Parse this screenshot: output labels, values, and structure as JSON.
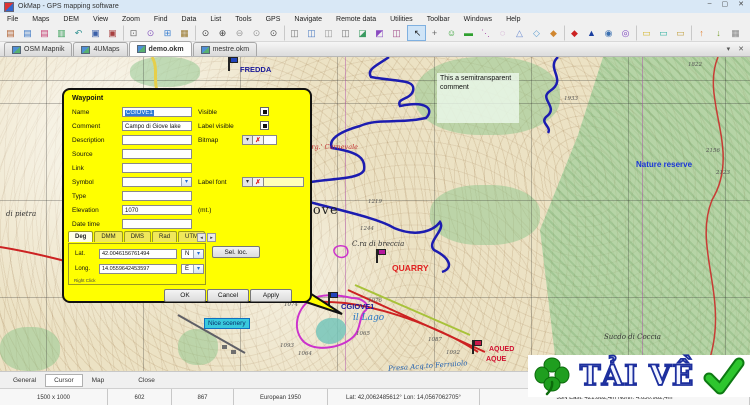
{
  "window": {
    "title": "OkMap - GPS mapping software",
    "controls": {
      "minimize": "–",
      "maximize": "▢",
      "close": "✕"
    }
  },
  "menu": {
    "items": [
      "File",
      "Maps",
      "DEM",
      "View",
      "Zoom",
      "Find",
      "Data",
      "List",
      "Tools",
      "GPS",
      "Navigate",
      "Remote data",
      "Utilities",
      "Toolbar",
      "Windows",
      "Help"
    ]
  },
  "toolbar": {
    "icons": [
      {
        "name": "open-map-icon",
        "glyph": "▤",
        "color": "#b06030"
      },
      {
        "name": "add-map-icon",
        "glyph": "▤",
        "color": "#3a76c4"
      },
      {
        "name": "remove-map-icon",
        "glyph": "▤",
        "color": "#c43a6e"
      },
      {
        "name": "map-list-icon",
        "glyph": "▥",
        "color": "#3aa05a"
      },
      {
        "name": "reload-map-icon",
        "glyph": "↶",
        "color": "#2e9090"
      },
      {
        "name": "save-icon",
        "glyph": "▣",
        "color": "#3a5fa8"
      },
      {
        "name": "save-as-icon",
        "glyph": "▣",
        "color": "#a84040"
      },
      {
        "name": "zoom-window-icon",
        "glyph": "⊡",
        "color": "#666666",
        "sep": true
      },
      {
        "name": "zoom-pan-icon",
        "glyph": "⊙",
        "color": "#8a5fc0"
      },
      {
        "name": "open-workspace-icon",
        "glyph": "⊞",
        "color": "#3a7fd0"
      },
      {
        "name": "briefcase-icon",
        "glyph": "▦",
        "color": "#9a7a30"
      },
      {
        "name": "find-icon",
        "glyph": "⊙",
        "color": "#444444",
        "sep": true
      },
      {
        "name": "zoom-in-icon",
        "glyph": "⊕",
        "color": "#444444"
      },
      {
        "name": "zoom-out-icon",
        "glyph": "⊖",
        "color": "#999999"
      },
      {
        "name": "zoom-previous-icon",
        "glyph": "⊙",
        "color": "#999999"
      },
      {
        "name": "zoom-scale-icon",
        "glyph": "⊙",
        "color": "#555555"
      },
      {
        "name": "waypoint-list-icon",
        "glyph": "◫",
        "color": "#777777",
        "sep": true
      },
      {
        "name": "route-list-icon",
        "glyph": "◫",
        "color": "#4a7ac0"
      },
      {
        "name": "track-list-icon",
        "glyph": "◫",
        "color": "#999999"
      },
      {
        "name": "area-list-icon",
        "glyph": "◫",
        "color": "#777777"
      },
      {
        "name": "upload-data-icon",
        "glyph": "◪",
        "color": "#3a9a60"
      },
      {
        "name": "download-data-icon",
        "glyph": "◩",
        "color": "#8a4ac0"
      },
      {
        "name": "sync-data-icon",
        "glyph": "◫",
        "color": "#a04a88"
      },
      {
        "name": "select-pointer-icon",
        "glyph": "↖",
        "color": "#222222",
        "active": true,
        "sep": true
      },
      {
        "name": "pan-tool-icon",
        "glyph": "+",
        "color": "#666666"
      },
      {
        "name": "new-waypoint-icon",
        "glyph": "☺",
        "color": "#2fa02f"
      },
      {
        "name": "new-label-icon",
        "glyph": "▬",
        "color": "#2fa02f"
      },
      {
        "name": "new-route-icon",
        "glyph": "⋱",
        "color": "#b05fb0"
      },
      {
        "name": "new-track-icon",
        "glyph": "◌",
        "color": "#b05fb0"
      },
      {
        "name": "new-area-icon",
        "glyph": "△",
        "color": "#6a8ad0"
      },
      {
        "name": "new-polygon-icon",
        "glyph": "◇",
        "color": "#5f9fd0"
      },
      {
        "name": "new-shape-icon",
        "glyph": "◆",
        "color": "#d0862f"
      },
      {
        "name": "center-map-icon",
        "glyph": "◆",
        "color": "#cc2222",
        "sep": true
      },
      {
        "name": "goto-position-icon",
        "glyph": "▲",
        "color": "#1a3fa0"
      },
      {
        "name": "rotate-map-icon",
        "glyph": "◉",
        "color": "#3a6fb0"
      },
      {
        "name": "projection-icon",
        "glyph": "◎",
        "color": "#7a3fbf"
      },
      {
        "name": "measure-distance-icon",
        "glyph": "▭",
        "color": "#d4b62e",
        "sep": true
      },
      {
        "name": "measure-area-icon",
        "glyph": "▭",
        "color": "#2fb0a0"
      },
      {
        "name": "measure-bearing-icon",
        "glyph": "▭",
        "color": "#c09f3f"
      },
      {
        "name": "gps-upload-icon",
        "glyph": "↑",
        "color": "#e07f2f",
        "sep": true
      },
      {
        "name": "gps-download-icon",
        "glyph": "↓",
        "color": "#79a02f"
      },
      {
        "name": "data-grid-icon",
        "glyph": "▦",
        "color": "#8a8a8a"
      }
    ]
  },
  "tabbar": {
    "tabs": [
      {
        "label": "OSM Mapnik"
      },
      {
        "label": "4UMaps"
      },
      {
        "label": "demo.okm",
        "active": true
      },
      {
        "label": "mestre.okm"
      }
    ],
    "dropdown_glyph": "▾",
    "close_glyph": "✕"
  },
  "map": {
    "comment_note": "This a semitransparent comment",
    "chip": {
      "text": "Nice scenery",
      "x": 204,
      "y": 261
    },
    "colors": {
      "track": "#1c1cb0",
      "route": "#cc2222",
      "area": "#cc33cc",
      "road_yellow": "#e6cf4a",
      "road_green": "#a8c23a",
      "road_gray": "#5f5f66"
    },
    "labels": [
      {
        "text": "FREDDA",
        "x": 240,
        "y": 8,
        "cls": "lbl-navy-bold"
      },
      {
        "text": "Sorg.' Carnevale",
        "x": 303,
        "y": 86,
        "cls": "lbl-red-italic"
      },
      {
        "text": "Nature reserve",
        "x": 636,
        "y": 103,
        "cls": "lbl-blue-bold"
      },
      {
        "text": "i Giove",
        "x": 286,
        "y": 146,
        "cls": "lbl-serif-big"
      },
      {
        "text": "C.ra di breccia",
        "x": 352,
        "y": 183,
        "cls": "lbl-italic"
      },
      {
        "text": "QUARRY",
        "x": 392,
        "y": 206,
        "cls": "lbl-red-bold"
      },
      {
        "text": "CGIOVE1",
        "x": 341,
        "y": 245,
        "cls": "lbl-navy-bold"
      },
      {
        "text": "il Lago",
        "x": 353,
        "y": 256,
        "cls": "lbl-blue-italic-lg"
      },
      {
        "text": "Sucdo di Coccia",
        "x": 604,
        "y": 276,
        "cls": "lbl-italic"
      },
      {
        "text": "Presa Acq.to Ferraiolo",
        "x": 388,
        "y": 305,
        "cls": "lbl-blue-italic",
        "transform": "rotate(-4deg)"
      },
      {
        "text": "AQUED",
        "x": 489,
        "y": 289,
        "cls": "lbl-red-bold-sm"
      },
      {
        "text": "AQUE",
        "x": 486,
        "y": 299,
        "cls": "lbl-red-bold-sm"
      },
      {
        "text": "di pietra",
        "x": 6,
        "y": 153,
        "cls": "lbl-italic"
      },
      {
        "text": "1074",
        "x": 284,
        "y": 245,
        "cls": "lbl-elev"
      },
      {
        "text": "1076",
        "x": 368,
        "y": 241,
        "cls": "lbl-elev"
      },
      {
        "text": "1065",
        "x": 356,
        "y": 274,
        "cls": "lbl-elev"
      },
      {
        "text": "1064",
        "x": 298,
        "y": 294,
        "cls": "lbl-elev"
      },
      {
        "text": "1093",
        "x": 280,
        "y": 286,
        "cls": "lbl-elev"
      },
      {
        "text": "1087",
        "x": 428,
        "y": 280,
        "cls": "lbl-elev"
      },
      {
        "text": "1092",
        "x": 446,
        "y": 293,
        "cls": "lbl-elev"
      },
      {
        "text": "1219",
        "x": 368,
        "y": 142,
        "cls": "lbl-elev"
      },
      {
        "text": "1244",
        "x": 360,
        "y": 169,
        "cls": "lbl-elev"
      },
      {
        "text": "1933",
        "x": 564,
        "y": 39,
        "cls": "lbl-elev"
      },
      {
        "text": "2156",
        "x": 706,
        "y": 91,
        "cls": "lbl-elev"
      },
      {
        "text": "2123",
        "x": 716,
        "y": 113,
        "cls": "lbl-elev"
      },
      {
        "text": "1822",
        "x": 688,
        "y": 5,
        "cls": "lbl-elev"
      }
    ],
    "markers": [
      {
        "name": "waypoint-flag-fredda",
        "x": 228,
        "y": 0,
        "color": "#2244bb"
      },
      {
        "name": "waypoint-flag-quarry",
        "x": 376,
        "y": 192,
        "color": "#b5179e"
      },
      {
        "name": "waypoint-flag-cgiove1",
        "x": 328,
        "y": 235,
        "color": "#2244bb"
      },
      {
        "name": "waypoint-flag-aqueduct",
        "x": 472,
        "y": 283,
        "color": "#c9184a"
      }
    ]
  },
  "dialog": {
    "title": "Waypoint",
    "name": {
      "label": "Name",
      "value": "CGIOVE1"
    },
    "comment": {
      "label": "Comment",
      "value": "Campo di Giove lake"
    },
    "description": {
      "label": "Description",
      "value": ""
    },
    "source": {
      "label": "Source",
      "value": ""
    },
    "link": {
      "label": "Link",
      "value": ""
    },
    "symbol": {
      "label": "Symbol",
      "value": ""
    },
    "type": {
      "label": "Type",
      "value": ""
    },
    "elevation": {
      "label": "Elevation",
      "value": "1070",
      "unit": "(mt.)"
    },
    "datetime": {
      "label": "Date time",
      "value": ""
    },
    "visible": {
      "label": "Visible",
      "checked": true
    },
    "label_visible": {
      "label": "Label visible",
      "checked": true
    },
    "bitmap": {
      "label": "Bitmap"
    },
    "label_font": {
      "label": "Label font"
    },
    "coord_tabs": [
      {
        "label": "Deg",
        "active": true
      },
      {
        "label": "DMM"
      },
      {
        "label": "DMS"
      },
      {
        "label": "Rad"
      },
      {
        "label": "UTM"
      }
    ],
    "lat": {
      "label": "Lat.",
      "value": "42.0046156761494",
      "hemisphere": "N"
    },
    "long": {
      "label": "Long.",
      "value": "14.0559642453597",
      "hemisphere": "E"
    },
    "hint": "Right Click",
    "sel_loc_button": "Sel. loc.",
    "ok_button": "OK",
    "cancel_button": "Cancel",
    "apply_button": "Apply",
    "icons": {
      "dropdown": "▾",
      "clear": "✗",
      "spin_left": "◂",
      "spin_right": "▸"
    }
  },
  "statusbar": {
    "tabs": [
      {
        "label": "General"
      },
      {
        "label": "Cursor",
        "active": true
      },
      {
        "label": "Map"
      }
    ],
    "close_label": "Close",
    "cells": [
      {
        "text": "1500 x 1000",
        "w": 108
      },
      {
        "text": "602",
        "w": 64
      },
      {
        "text": "867",
        "w": 62
      },
      {
        "text": "European 1950",
        "w": 94
      },
      {
        "text": "Lat: 42,0062485612°  Lon: 14,0567062705°",
        "w": 152
      },
      {
        "text": "33N  East: 421.882,4m  North: 4.650.982,4m",
        "w": 270
      }
    ]
  },
  "watermark": {
    "text": "TẢI VỀ"
  }
}
